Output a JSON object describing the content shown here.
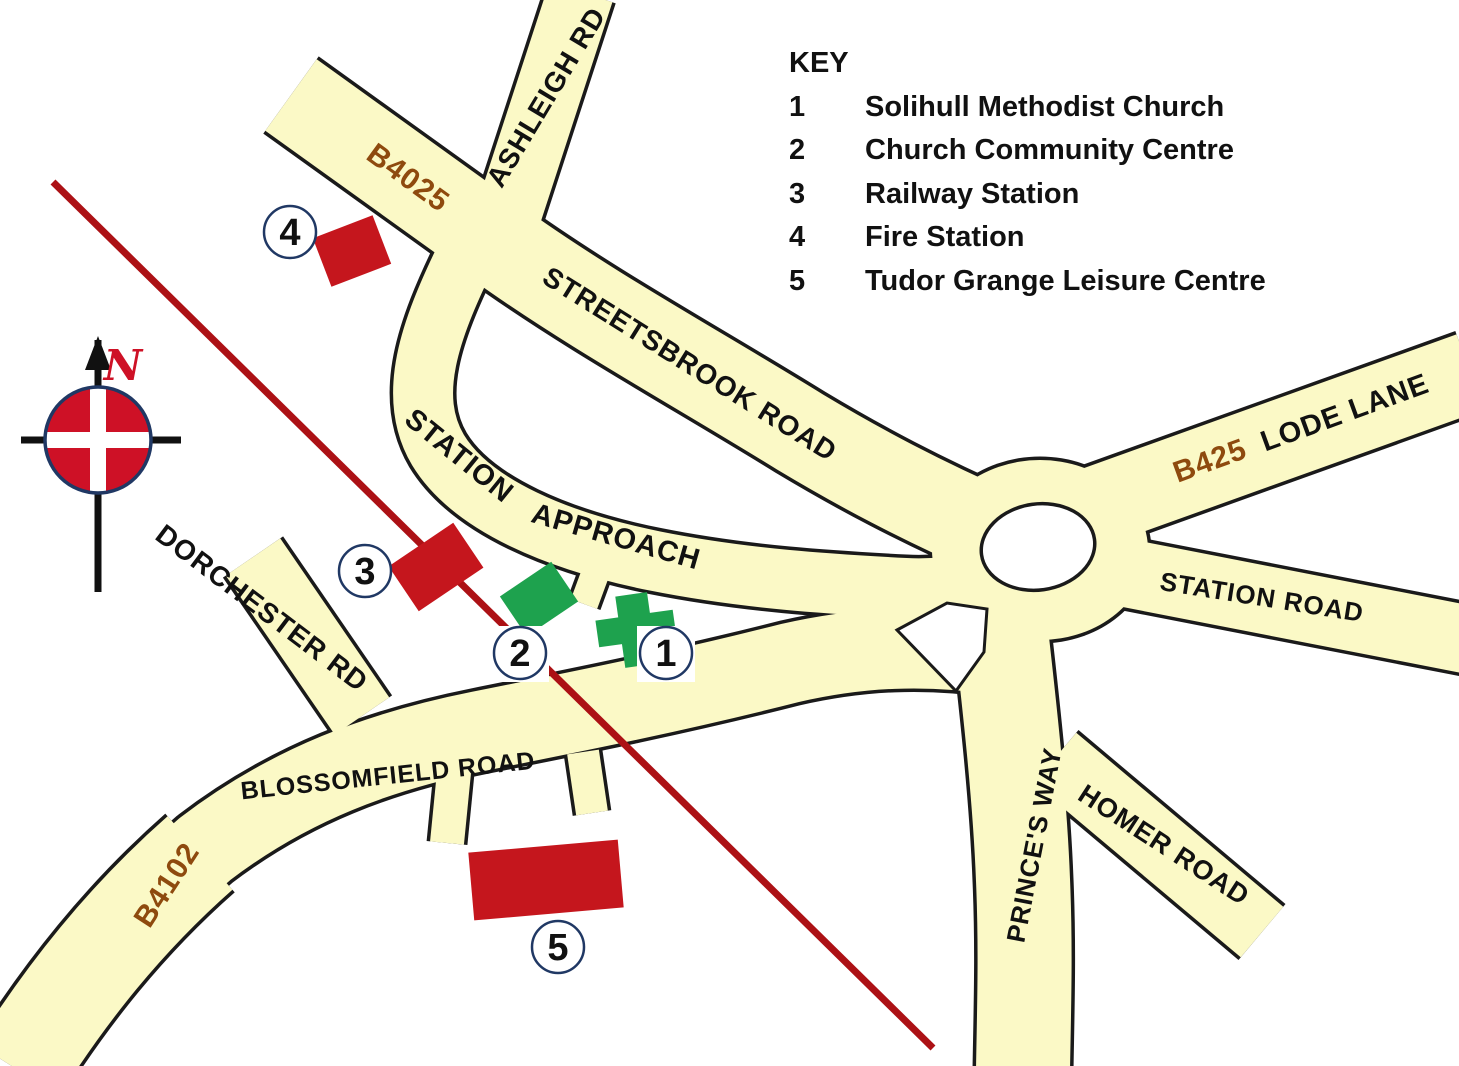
{
  "key": {
    "title": "KEY",
    "items": [
      {
        "num": "1",
        "label": "Solihull Methodist Church"
      },
      {
        "num": "2",
        "label": "Church Community Centre"
      },
      {
        "num": "3",
        "label": "Railway Station"
      },
      {
        "num": "4",
        "label": "Fire Station"
      },
      {
        "num": "5",
        "label": "Tudor Grange Leisure Centre"
      }
    ]
  },
  "roads": {
    "b4025": "B4025",
    "ashleigh_rd": "ASHLEIGH RD",
    "streetsbrook_road": "STREETSBROOK ROAD",
    "station_word": "STATION",
    "approach_word": "APPROACH",
    "b425": "B425",
    "lode_lane": "LODE LANE",
    "station_road": "STATION ROAD",
    "dorchester_rd": "DORCHESTER RD",
    "blossomfield_road": "BLOSSOMFIELD ROAD",
    "b4102": "B4102",
    "princes_way": "PRINCE'S WAY",
    "homer_road": "HOMER ROAD"
  },
  "markers": [
    {
      "num": "1",
      "name": "Solihull Methodist Church"
    },
    {
      "num": "2",
      "name": "Church Community Centre"
    },
    {
      "num": "3",
      "name": "Railway Station"
    },
    {
      "num": "4",
      "name": "Fire Station"
    },
    {
      "num": "5",
      "name": "Tudor Grange Leisure Centre"
    }
  ],
  "compass": {
    "north": "N"
  },
  "colors": {
    "road_fill": "#FBF9C6",
    "road_outline": "#1A1A1A",
    "route_number_text": "#8E4A0E",
    "building_red": "#C5161D",
    "building_green": "#1EA24E",
    "railway_line": "#AC1115",
    "marker_ring": "#203864",
    "compass_rose_red": "#CE1126"
  }
}
